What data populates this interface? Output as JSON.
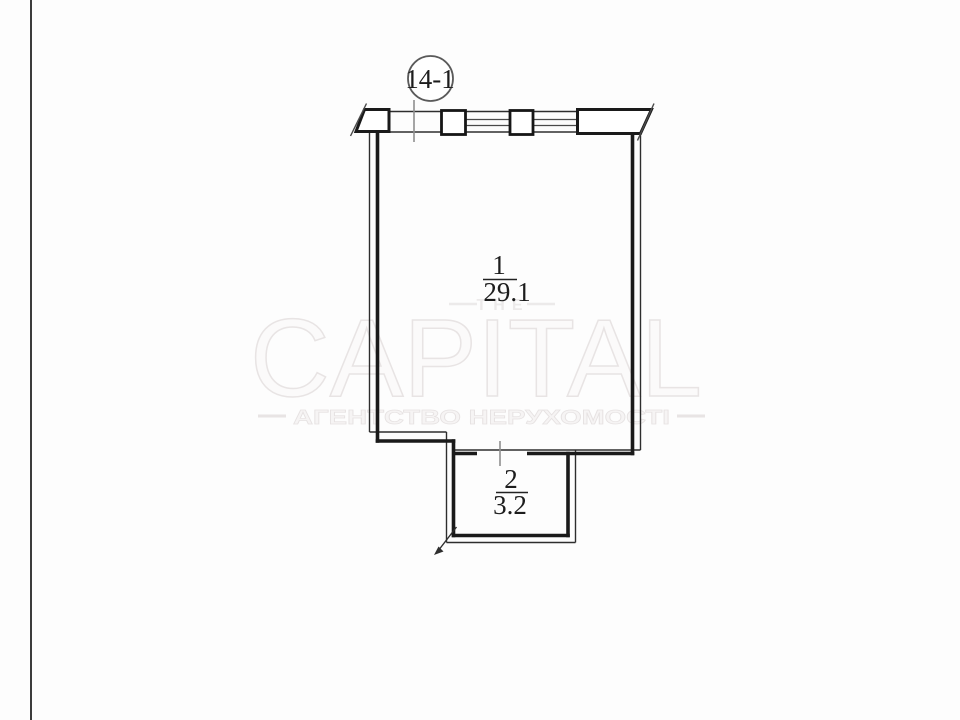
{
  "page": {
    "background": "#fdfdfd",
    "edge_line_color": "#3c3c3c"
  },
  "floor_plan": {
    "section_label": "14-1",
    "rooms": [
      {
        "number": "1",
        "area": "29.1"
      },
      {
        "number": "2",
        "area": "3.2"
      }
    ],
    "colors": {
      "wall": "#1a1a1a",
      "thin_line": "#2e2e2e",
      "leader": "#8f8f8f"
    }
  },
  "watermark": {
    "top_word": "THE",
    "brand": "CAPITAL",
    "tagline": "АГЕНТСТВО НЕРУХОМОСТІ",
    "color": "#e9e5e5"
  }
}
